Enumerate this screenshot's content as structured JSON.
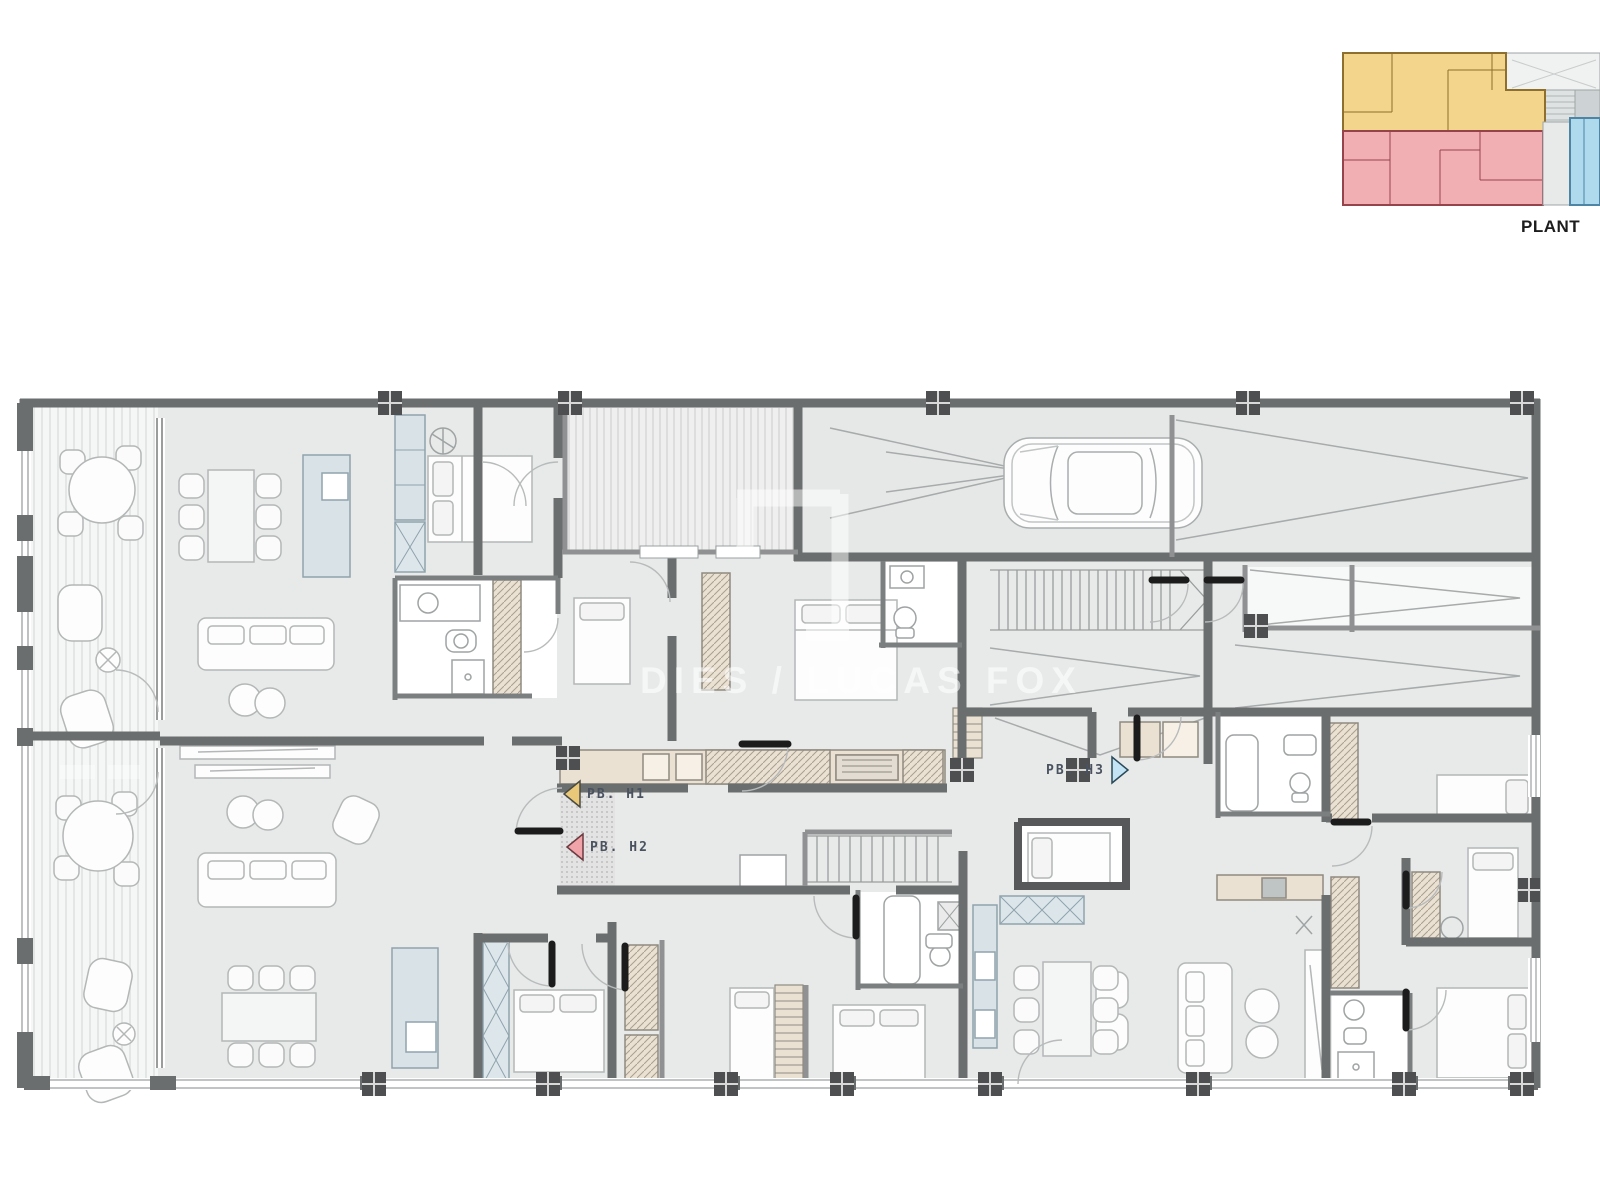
{
  "key_plan": {
    "caption": "PLANT",
    "zones": {
      "h1_fill": "#F3D68C",
      "h1_stroke": "#8E6F2E",
      "h2_fill": "#F2AFB3",
      "h2_stroke": "#96444C",
      "h3_fill": "#AFD9EC",
      "h3_stroke": "#4E85A5",
      "roof_fill": "#F0F1F1",
      "core_fill": "#CDD2D4"
    }
  },
  "unit_markers": [
    {
      "label": "PB. H1",
      "color": "#E9C979",
      "direction": "left"
    },
    {
      "label": "PB. H2",
      "color": "#F0A4A9",
      "direction": "left"
    },
    {
      "label": "PB. H3",
      "color": "#C2E4F4",
      "direction": "right"
    }
  ],
  "watermark": {
    "text": "DIES / LUCAS FOX"
  },
  "plan_palette": {
    "wall": "#6B6E6F",
    "floor": "#E8EAEA",
    "terrace": "#F5F6F6",
    "cabinet": "#EBE1D3",
    "accent_blue": "#D9E2E6"
  }
}
